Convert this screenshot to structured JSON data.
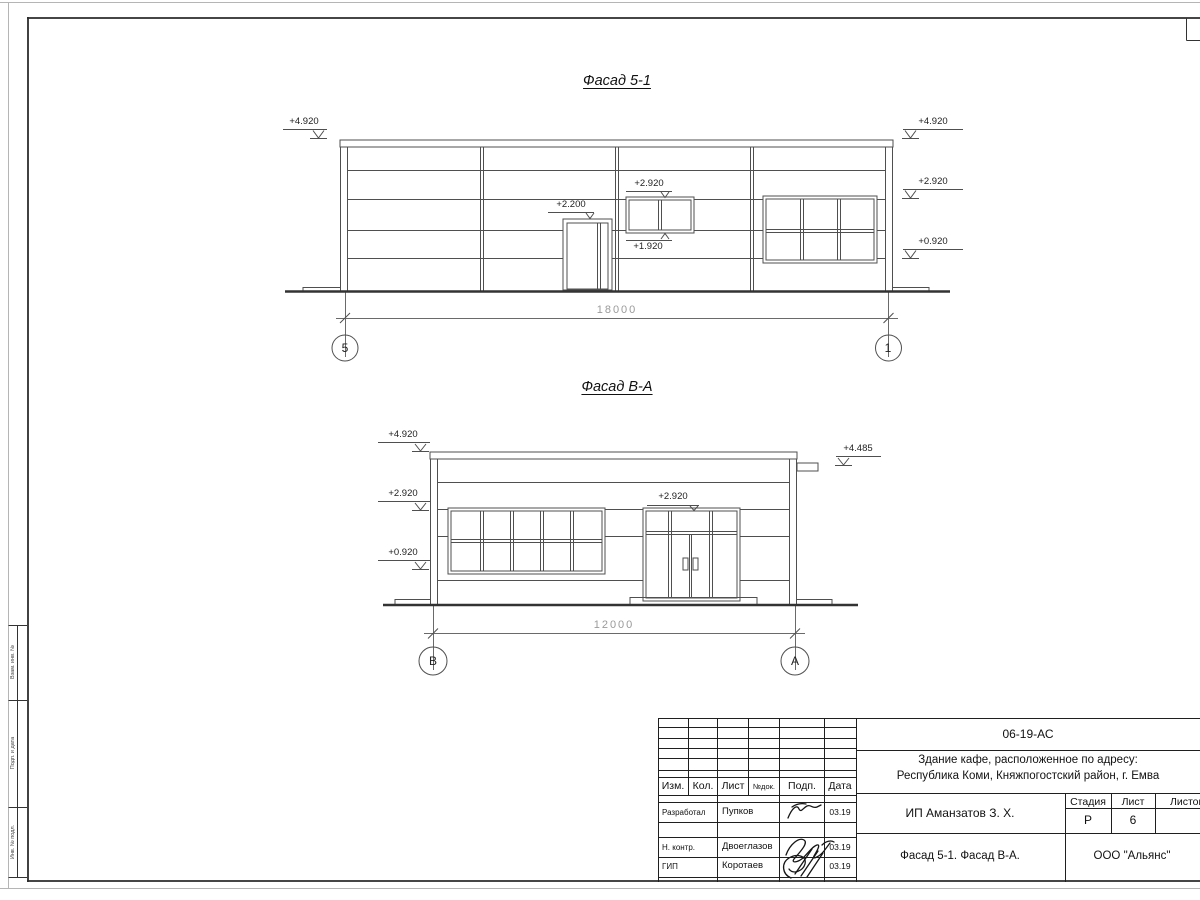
{
  "sheet": {
    "side_labels": [
      "Взам. инв. №",
      "Подп. и дата",
      "Инв. № подл."
    ]
  },
  "facade1": {
    "title": "Фасад 5-1",
    "dim": "18000",
    "axis_left": "5",
    "axis_right": "1",
    "levels": {
      "left_top": "+4.920",
      "right_top": "+4.920",
      "right_mid": "+2.920",
      "right_low": "+0.920",
      "door": "+2.200",
      "win_top": "+2.920",
      "win_bottom": "+1.920"
    }
  },
  "facade2": {
    "title": "Фасад В-А",
    "dim": "12000",
    "axis_left": "В",
    "axis_right": "А",
    "levels": {
      "left_top": "+4.920",
      "left_mid": "+2.920",
      "left_low": "+0.920",
      "right_top": "+4.485",
      "door": "+2.920"
    }
  },
  "title_block": {
    "doc_number": "06-19-АС",
    "project_line1": "Здание кафе, расположенное по адресу:",
    "project_line2": "Республика Коми, Княжпогостский район, г. Емва",
    "client": "ИП Аманзатов З. Х.",
    "sheet_title": "Фасад 5-1. Фасад В-А.",
    "company": "ООО \"Альянс\"",
    "col_izm": "Изм.",
    "col_kol": "Кол.",
    "col_list": "Лист",
    "col_ndok": "№док.",
    "col_podp": "Подп.",
    "col_data": "Дата",
    "stage_label": "Стадия",
    "sheet_label": "Лист",
    "sheets_label": "Листов",
    "stage": "Р",
    "sheet_no": "6",
    "rows": [
      {
        "role": "Разработал",
        "name": "Пупков",
        "date": "03.19"
      },
      {
        "role": "Н. контр.",
        "name": "Двоеглазов",
        "date": "03.19"
      },
      {
        "role": "ГИП",
        "name": "Коротаев",
        "date": "03.19"
      }
    ]
  }
}
